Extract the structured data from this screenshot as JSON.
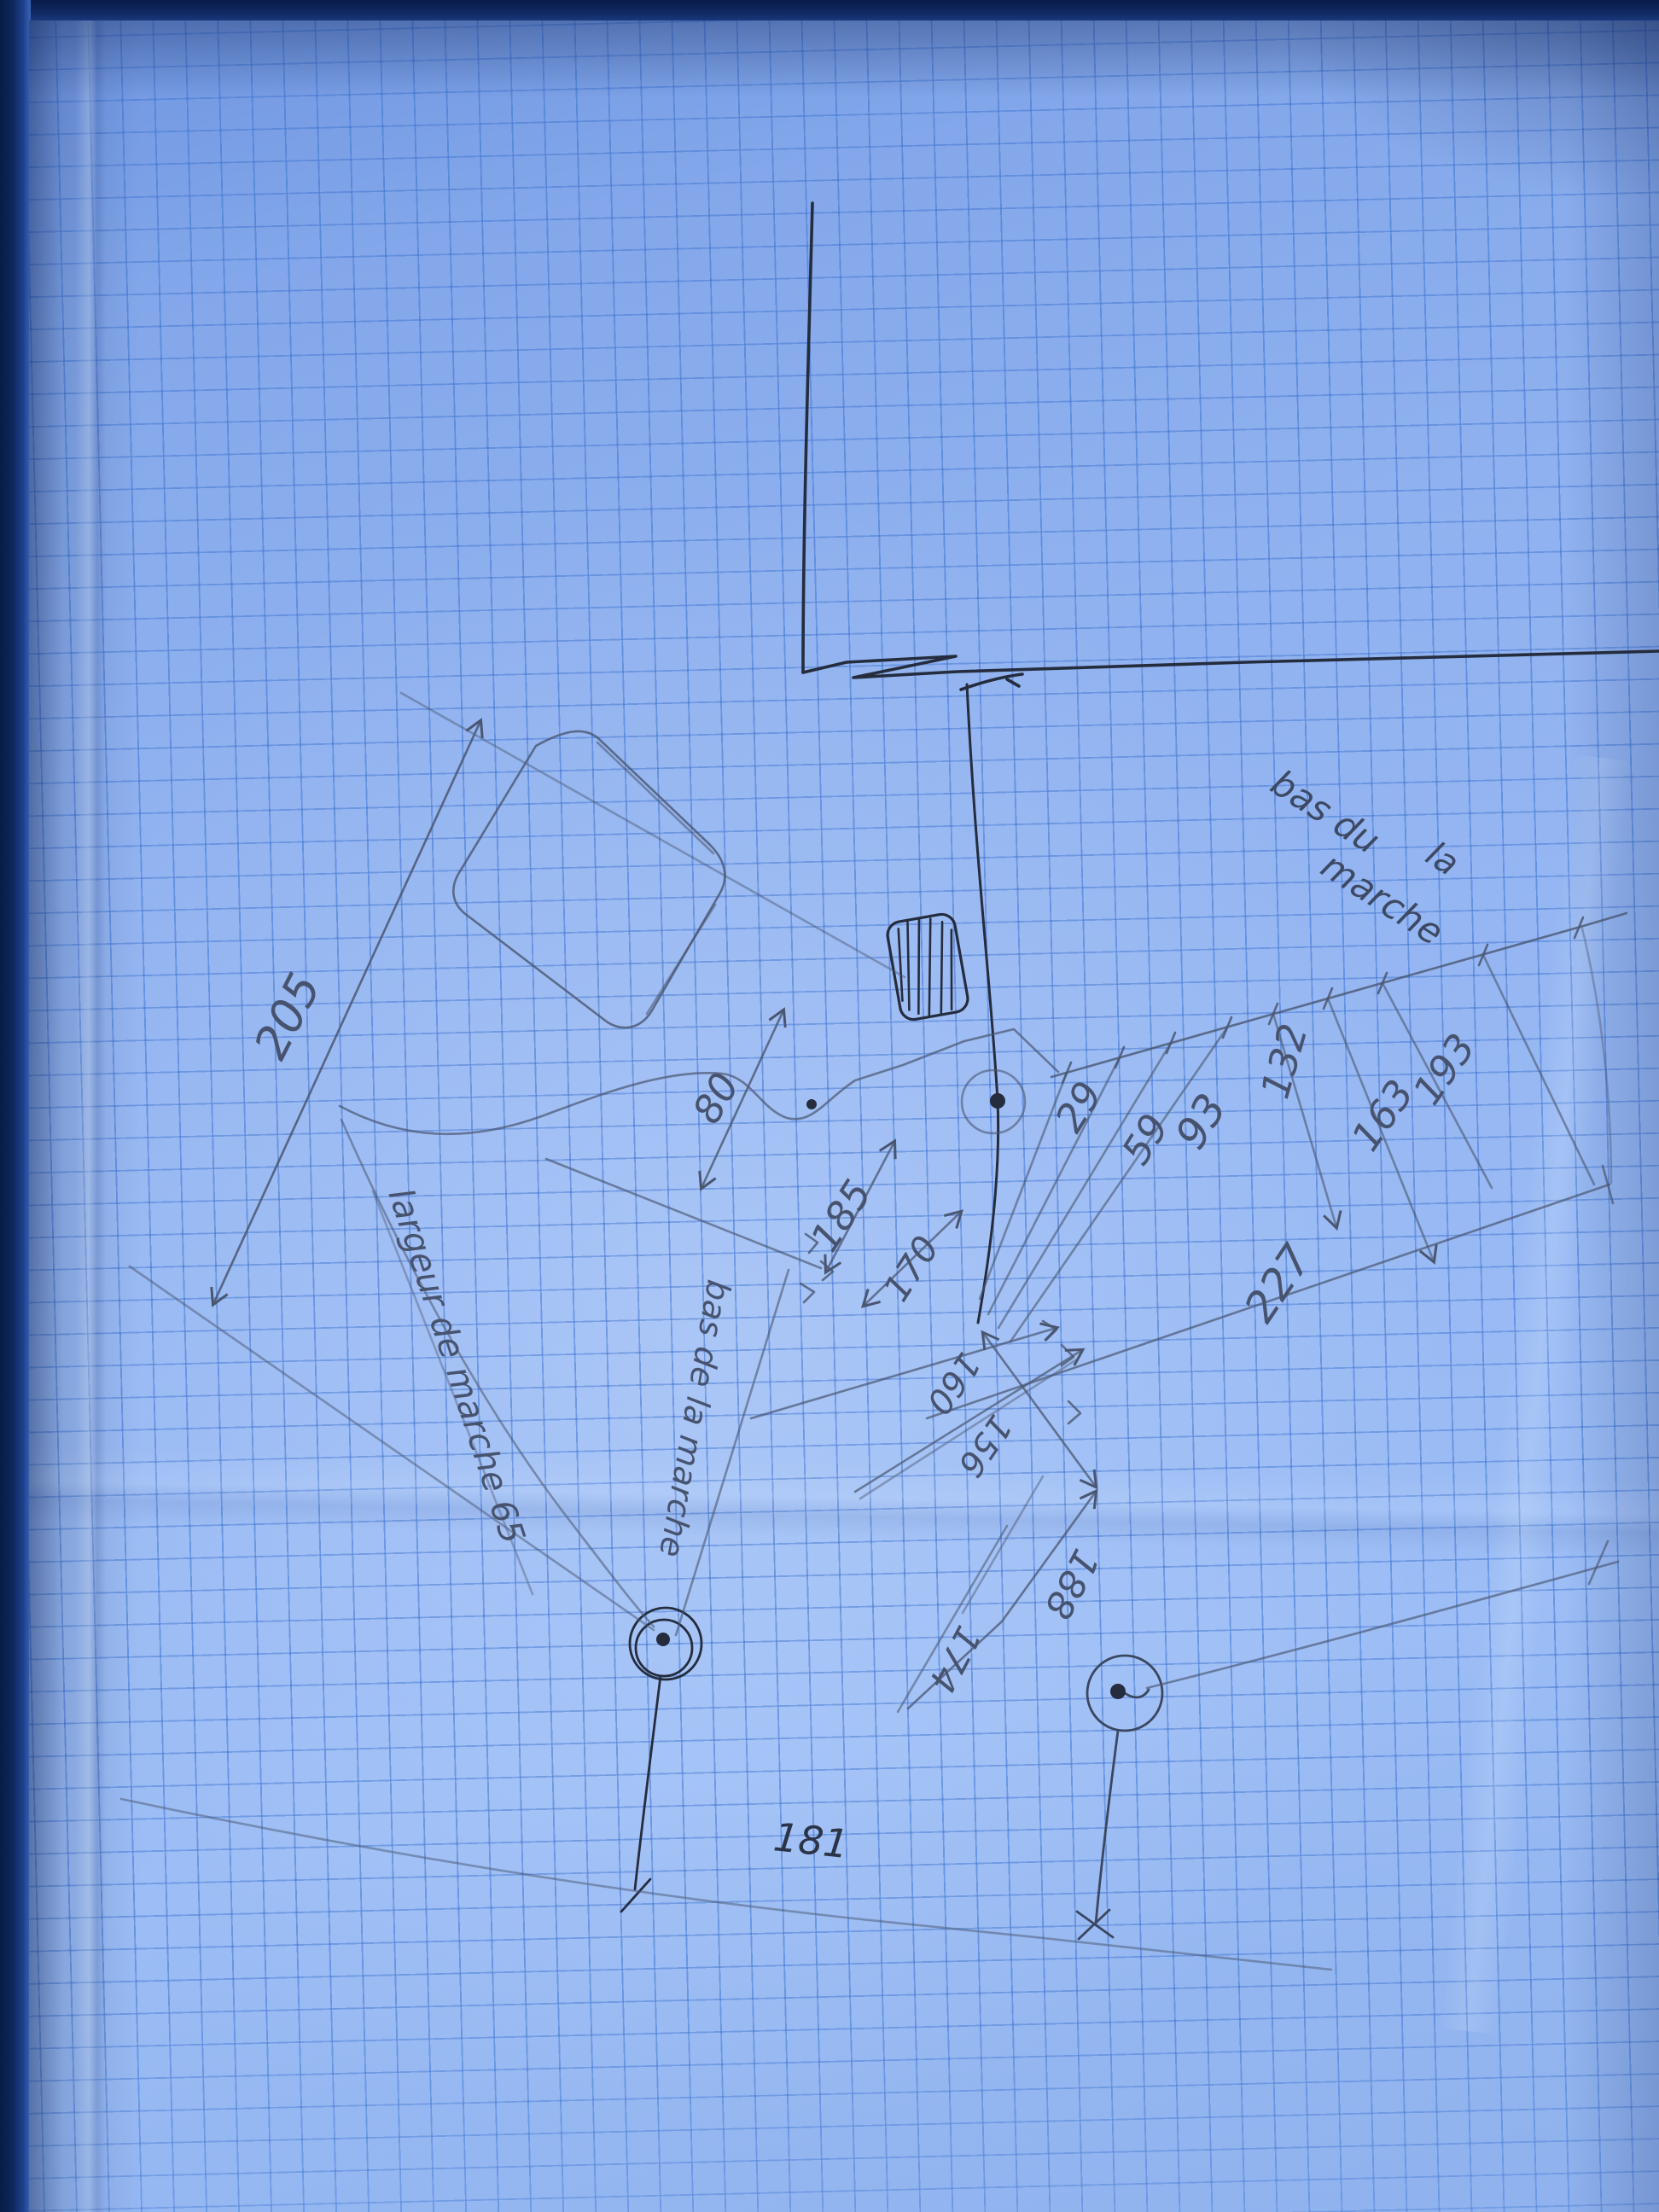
{
  "photo": {
    "description": "hand-drawn dimensioned sketch in pen and pencil on blue squared graph paper",
    "language": "French"
  },
  "notes": {
    "bas_du": "bas du",
    "la": "la",
    "marche": "marche",
    "largeur_de_marche": "largeur de marche 65",
    "bas_de_la_marche": "bas de la marche"
  },
  "measurements": {
    "d205": "205",
    "d80": "80",
    "d185": "185",
    "d170": "170",
    "d29": "29",
    "d59": "59",
    "d93": "93",
    "d132": "132",
    "d163": "163",
    "d193": "193",
    "d227": "227",
    "d160": "160",
    "d156": "156",
    "d188": "188",
    "d174": "174",
    "d181": "181"
  },
  "colors": {
    "paper": "#93b3ef",
    "grid": "#3f77cd",
    "pencil": "#4a5670",
    "ink": "#242c3e",
    "background": "#102c68"
  }
}
